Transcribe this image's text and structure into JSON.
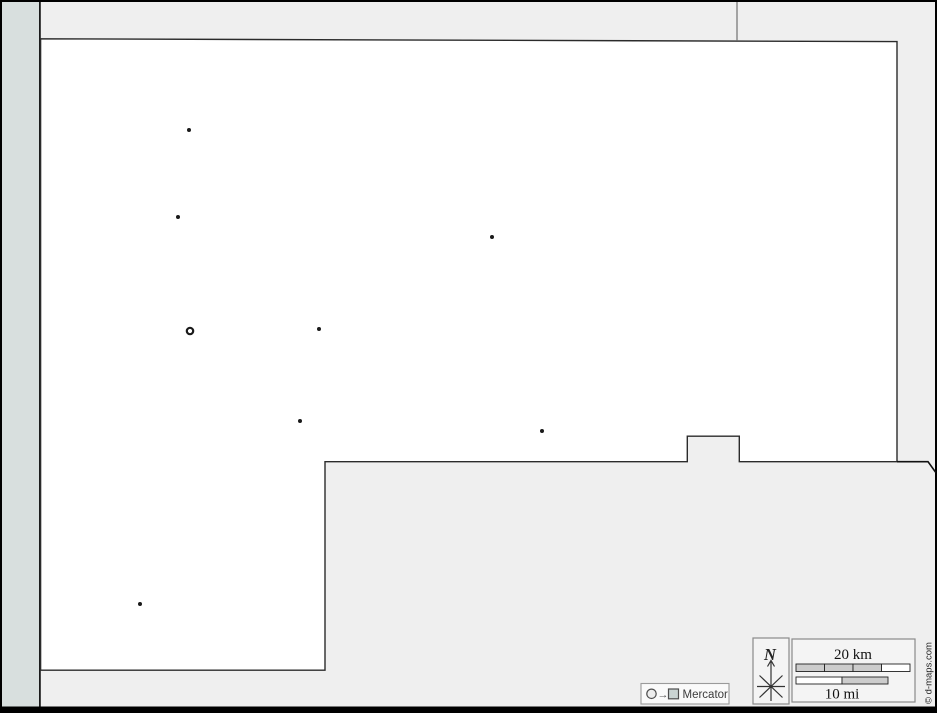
{
  "map": {
    "markers": [
      {
        "x": 189,
        "y": 130,
        "type": "city"
      },
      {
        "x": 178,
        "y": 217,
        "type": "city"
      },
      {
        "x": 492,
        "y": 237,
        "type": "city"
      },
      {
        "x": 190,
        "y": 331,
        "type": "capital"
      },
      {
        "x": 319,
        "y": 329,
        "type": "city"
      },
      {
        "x": 300,
        "y": 421,
        "type": "city"
      },
      {
        "x": 542,
        "y": 431,
        "type": "city"
      },
      {
        "x": 140,
        "y": 604,
        "type": "city"
      }
    ],
    "colors": {
      "sea": "#d8dfde",
      "neighbor": "#efefef",
      "land": "#ffffff",
      "frame": "#000000",
      "boundary": "#2b2b2b",
      "divider": "#7a7a7a",
      "marker": "#1a1a1a",
      "legend_box": "#f4f4f4",
      "legend_border": "#8a8a8a",
      "scale_segment_gray": "#cccccc",
      "scale_segment_white": "#ffffff"
    }
  },
  "legend": {
    "projection": {
      "label": "Mercator",
      "arrow_glyph": "→"
    },
    "compass": {
      "north_label": "N"
    },
    "scale": {
      "km_label": "20 km",
      "mi_label": "10 mi"
    },
    "copyright": "© d-maps.com"
  }
}
